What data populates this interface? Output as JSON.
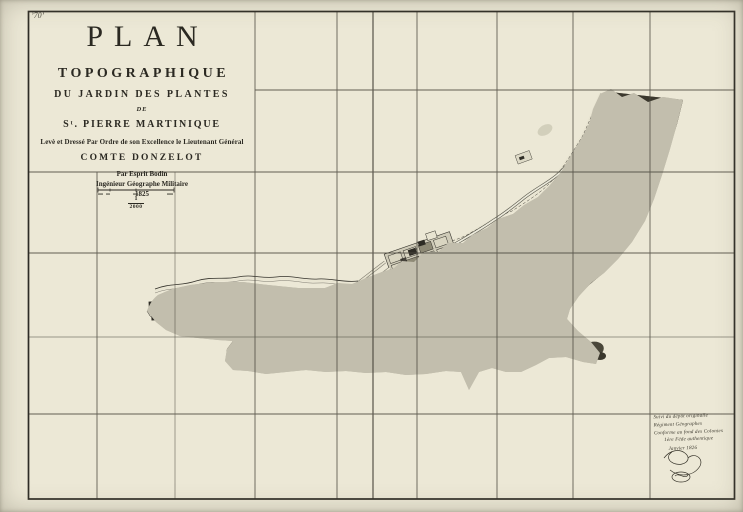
{
  "page": {
    "corner_mark": "’70’",
    "description": "Engraved topographic map sheet, dissected with sheet-join grid lines"
  },
  "title_block": {
    "title": "PLAN",
    "subtitle": "TOPOGRAPHIQUE",
    "line_of": "DU JARDIN DES PLANTES",
    "line_de": "DE",
    "place": "Sᵗ. PIERRE MARTINIQUE",
    "dedication": "Levè et Dressé Par Ordre de son Excellence le Lieutenant Général",
    "dedicatee": "COMTE DONZELOT",
    "author": "Par Esprit Bodin",
    "author_title": "Ingénieur Géographe Militaire",
    "year": "1825"
  },
  "scale": {
    "numerator": "1",
    "denominator": "2000"
  },
  "annotation": {
    "lines": [
      "Suivi du dépôt originalle",
      "Régiment Géographes",
      "Conforme au fond des Colonies",
      "1ère Féde authentique",
      "Janvier 1826"
    ]
  },
  "colors": {
    "paper": "#ece8d6",
    "ink": "#2b2922",
    "grid": "#4a473d",
    "wash": "#c2bead",
    "dark_mass": "#3b382d",
    "mid_tone": "#93907d",
    "light_path": "#e9e5d2"
  }
}
